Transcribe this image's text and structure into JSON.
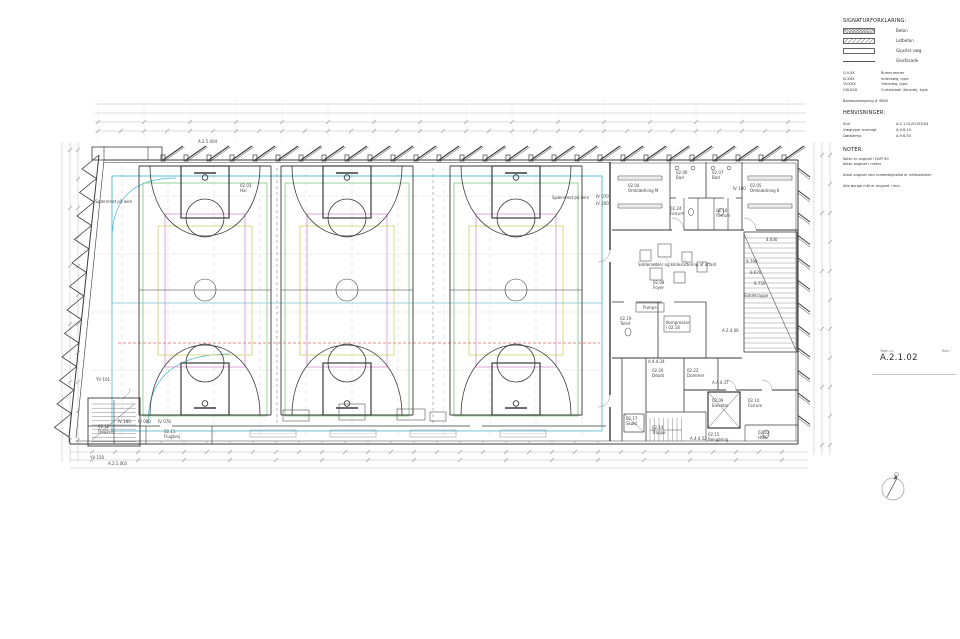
{
  "legend": {
    "title": "SIGNATURFORKLARING:",
    "items": [
      {
        "swatch": "sw-beton",
        "label": "Beton"
      },
      {
        "swatch": "sw-letbeton",
        "label": "Letbeton"
      },
      {
        "swatch": "sw-let",
        "label": "Gips/let væg"
      },
      {
        "swatch": "sw-glas",
        "label": "Glasfacade"
      }
    ],
    "codes": [
      [
        "O.V.XX",
        "Rumnummer"
      ],
      [
        "IV.XXX",
        "Indervæg, type"
      ],
      [
        "YV.XXX",
        "Ydervæg, type"
      ],
      [
        "CW.XXX",
        "Curtainwall (facade), type"
      ]
    ],
    "extra_note": "Baneopstregning jf. 9805"
  },
  "references": {
    "title": "HENVISNINGER:",
    "rows": [
      [
        "Snit",
        "A.3.1.01/02/03/04"
      ],
      [
        "Vægtyper oversigt",
        "A.9.6.10"
      ],
      [
        "Dørskema",
        "A.9.6.50"
      ]
    ]
  },
  "notes": {
    "title": "NOTER:",
    "lines": [
      "Koter er angivet i DVR 90",
      "Koter angivet i meter",
      "",
      "Areal angivet ved rumbetegnelse er nettoarealer",
      "",
      "Alle øvrige mål er angivet i mm."
    ]
  },
  "titleblock": {
    "label": "Tegn.nr.",
    "number": "A.2.1.02",
    "rev_label": "Rev.:"
  },
  "plan": {
    "colors": {
      "cyan": "#4fb9cf",
      "green": "#6fbf6f",
      "magenta": "#cf7fcf",
      "yellow": "#c9c951",
      "red": "#e06666"
    },
    "labels": [
      {
        "t": "02.03\nHal",
        "x": 240,
        "y": 183
      },
      {
        "t": "Spærrenet på wire",
        "x": 95,
        "y": 199
      },
      {
        "t": "Spærrenet på wire",
        "x": 552,
        "y": 195
      },
      {
        "t": "IV 070",
        "x": 596,
        "y": 194
      },
      {
        "t": "IV 200",
        "x": 596,
        "y": 201
      },
      {
        "t": "02.04\nOmklædning M",
        "x": 628,
        "y": 183
      },
      {
        "t": "02.05\nOmklædning K",
        "x": 750,
        "y": 183
      },
      {
        "t": "02.06\nBad",
        "x": 676,
        "y": 170
      },
      {
        "t": "02.07\nBad",
        "x": 712,
        "y": 170
      },
      {
        "t": "02.24\nForrum",
        "x": 670,
        "y": 206
      },
      {
        "t": "02.16\nForrum",
        "x": 716,
        "y": 208
      },
      {
        "t": "IV 100",
        "x": 733,
        "y": 186
      },
      {
        "t": "Siddemøbler og kildesortering af affald",
        "x": 638,
        "y": 262
      },
      {
        "t": "02.08\nFoyer",
        "x": 653,
        "y": 280
      },
      {
        "t": "Pumpe",
        "x": 643,
        "y": 305
      },
      {
        "t": "Kompressor\ni 02.18",
        "x": 666,
        "y": 320
      },
      {
        "t": "02.19\nToilet",
        "x": 620,
        "y": 316
      },
      {
        "t": "Siddetrappe",
        "x": 744,
        "y": 293
      },
      {
        "t": "9.790",
        "x": 746,
        "y": 259
      },
      {
        "t": "9.670",
        "x": 750,
        "y": 270
      },
      {
        "t": "9.750",
        "x": 754,
        "y": 281
      },
      {
        "t": "4.630",
        "x": 766,
        "y": 237
      },
      {
        "t": "A.2.4.06",
        "x": 722,
        "y": 328
      },
      {
        "t": "02.20\nDepot",
        "x": 652,
        "y": 368
      },
      {
        "t": "02.22\nDommer",
        "x": 687,
        "y": 368
      },
      {
        "t": "02.09\nElevator",
        "x": 712,
        "y": 398
      },
      {
        "t": "02.10\nForrum",
        "x": 748,
        "y": 398
      },
      {
        "t": "02.17\nSkakt",
        "x": 626,
        "y": 416
      },
      {
        "t": "02.14\nTrappe",
        "x": 652,
        "y": 425
      },
      {
        "t": "02.15\nRengøring",
        "x": 708,
        "y": 432
      },
      {
        "t": "02.02\nHWC",
        "x": 758,
        "y": 430
      },
      {
        "t": "A.4.4.34",
        "x": 648,
        "y": 359
      },
      {
        "t": "A.4.4.37",
        "x": 712,
        "y": 380
      },
      {
        "t": "A.4.4.52",
        "x": 690,
        "y": 436
      },
      {
        "t": "02.12\nFlugtvej",
        "x": 98,
        "y": 424
      },
      {
        "t": "02.11\nFlugtvej",
        "x": 164,
        "y": 429
      },
      {
        "t": "YV 101",
        "x": 96,
        "y": 377
      },
      {
        "t": "IV 180",
        "x": 118,
        "y": 419
      },
      {
        "t": "IV 080",
        "x": 138,
        "y": 419
      },
      {
        "t": "IV 078",
        "x": 158,
        "y": 419
      },
      {
        "t": "YV 150",
        "x": 90,
        "y": 455
      },
      {
        "t": "A.2.5.003",
        "x": 108,
        "y": 461
      },
      {
        "t": "A.2.5.004",
        "x": 198,
        "y": 139
      }
    ]
  }
}
